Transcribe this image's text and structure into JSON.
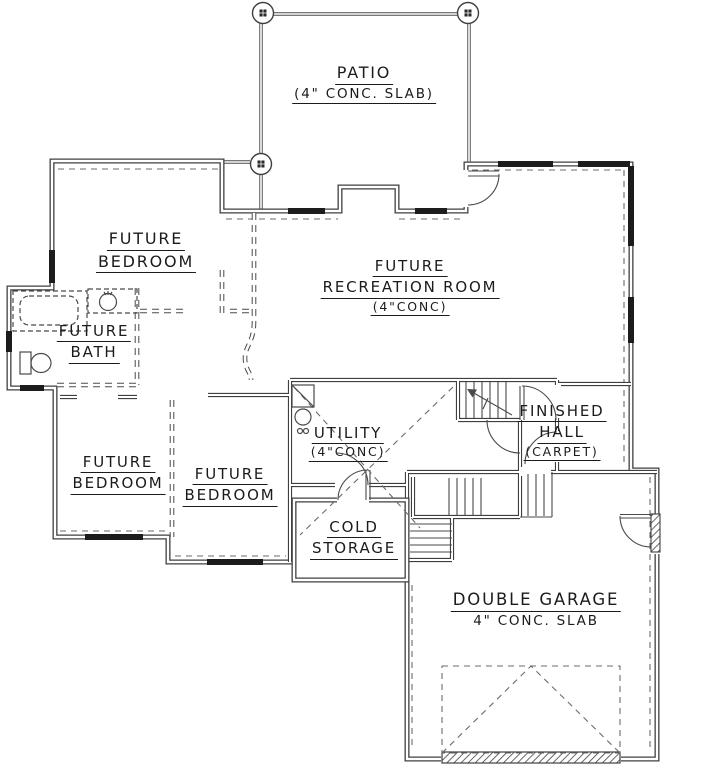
{
  "drawing": {
    "title": "basement floor plan",
    "line_color": "#3f3f3f",
    "rooms": {
      "patio": {
        "name": "PATIO",
        "note": "(4\" CONC. SLAB)"
      },
      "future_bedroom_nw": {
        "line1": "FUTURE",
        "line2": "BEDROOM"
      },
      "future_recreation_room": {
        "line1": "FUTURE",
        "line2": "RECREATION ROOM",
        "note": "(4\"CONC)"
      },
      "future_bath": {
        "line1": "FUTURE",
        "line2": "BATH"
      },
      "future_bedroom_sw": {
        "line1": "FUTURE",
        "line2": "BEDROOM"
      },
      "future_bedroom_s": {
        "line1": "FUTURE",
        "line2": "BEDROOM"
      },
      "utility": {
        "name": "UTILITY",
        "note": "(4\"CONC)"
      },
      "finished_hall": {
        "line1": "FINISHED",
        "line2": "HALL",
        "note": "(CARPET)"
      },
      "cold_storage": {
        "line1": "COLD",
        "line2": "STORAGE"
      },
      "double_garage": {
        "name": "DOUBLE GARAGE",
        "note": "4\" CONC. SLAB"
      }
    }
  }
}
